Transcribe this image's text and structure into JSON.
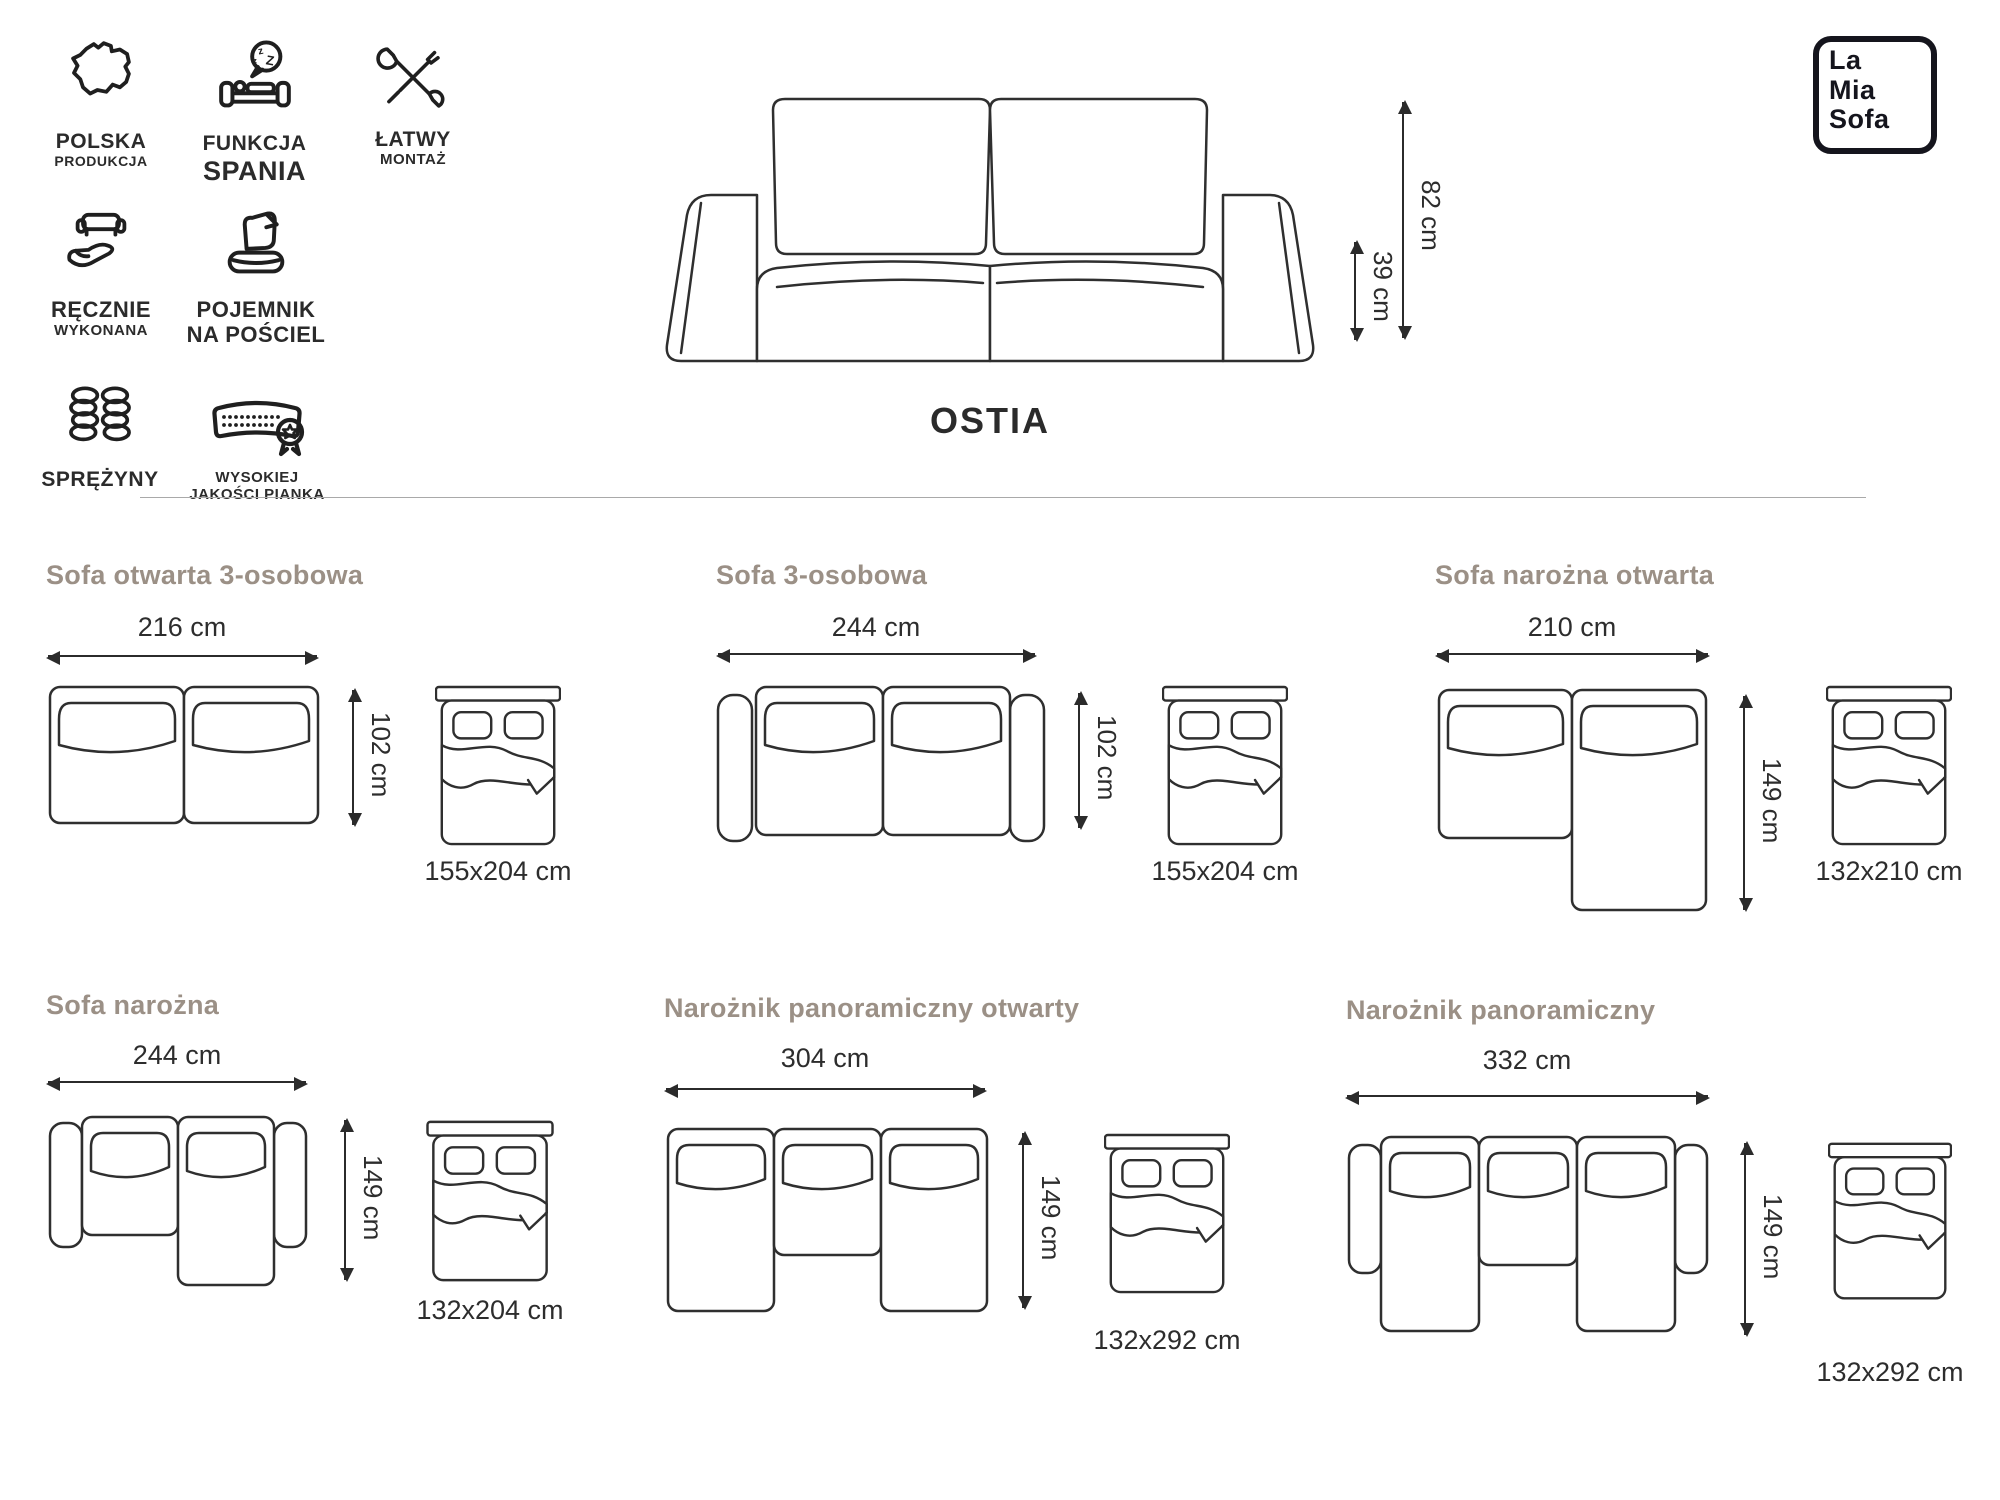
{
  "badges": [
    {
      "icon": "poland-map-icon",
      "line1": "POLSKA",
      "line2": "PRODUKCJA"
    },
    {
      "icon": "sleep-function-icon",
      "line1": "FUNKCJA",
      "line2": "SPANIA"
    },
    {
      "icon": "easy-assembly-icon",
      "line1": "ŁATWY",
      "line2": "MONTAŻ"
    },
    {
      "icon": "handmade-icon",
      "line1": "RĘCZNIE",
      "line2": "WYKONANA"
    },
    {
      "icon": "bedding-storage-icon",
      "line1": "POJEMNIK",
      "line2": "NA POŚCIEL"
    },
    {
      "icon": "springs-icon",
      "line1": "SPRĘŻYNY",
      "line2": ""
    },
    {
      "icon": "foam-quality-icon",
      "line1": "WYSOKIEJ",
      "line2": "JAKOŚCI PIANKA"
    }
  ],
  "logo": {
    "line1": "La",
    "line2": "Mia",
    "line3": "Sofa"
  },
  "product": {
    "name": "OSTIA",
    "height": "82 cm",
    "seat_height": "39 cm"
  },
  "sections": [
    {
      "title": "Sofa otwarta 3-osobowa",
      "width": "216 cm",
      "depth": "102 cm",
      "bed": "155x204 cm"
    },
    {
      "title": "Sofa 3-osobowa",
      "width": "244 cm",
      "depth": "102 cm",
      "bed": "155x204 cm"
    },
    {
      "title": "Sofa narożna otwarta",
      "width": "210 cm",
      "depth": "149 cm",
      "bed": "132x210 cm"
    },
    {
      "title": "Sofa narożna",
      "width": "244 cm",
      "depth": "149 cm",
      "bed": "132x204 cm"
    },
    {
      "title": "Narożnik panoramiczny otwarty",
      "width": "304 cm",
      "depth": "149 cm",
      "bed": "132x292 cm"
    },
    {
      "title": "Narożnik panoramiczny",
      "width": "332 cm",
      "depth": "149 cm",
      "bed": "132x292 cm"
    }
  ],
  "colors": {
    "ink": "#2b2b2b",
    "section_heading": "#9b9086",
    "divider": "#a9a9a9"
  }
}
